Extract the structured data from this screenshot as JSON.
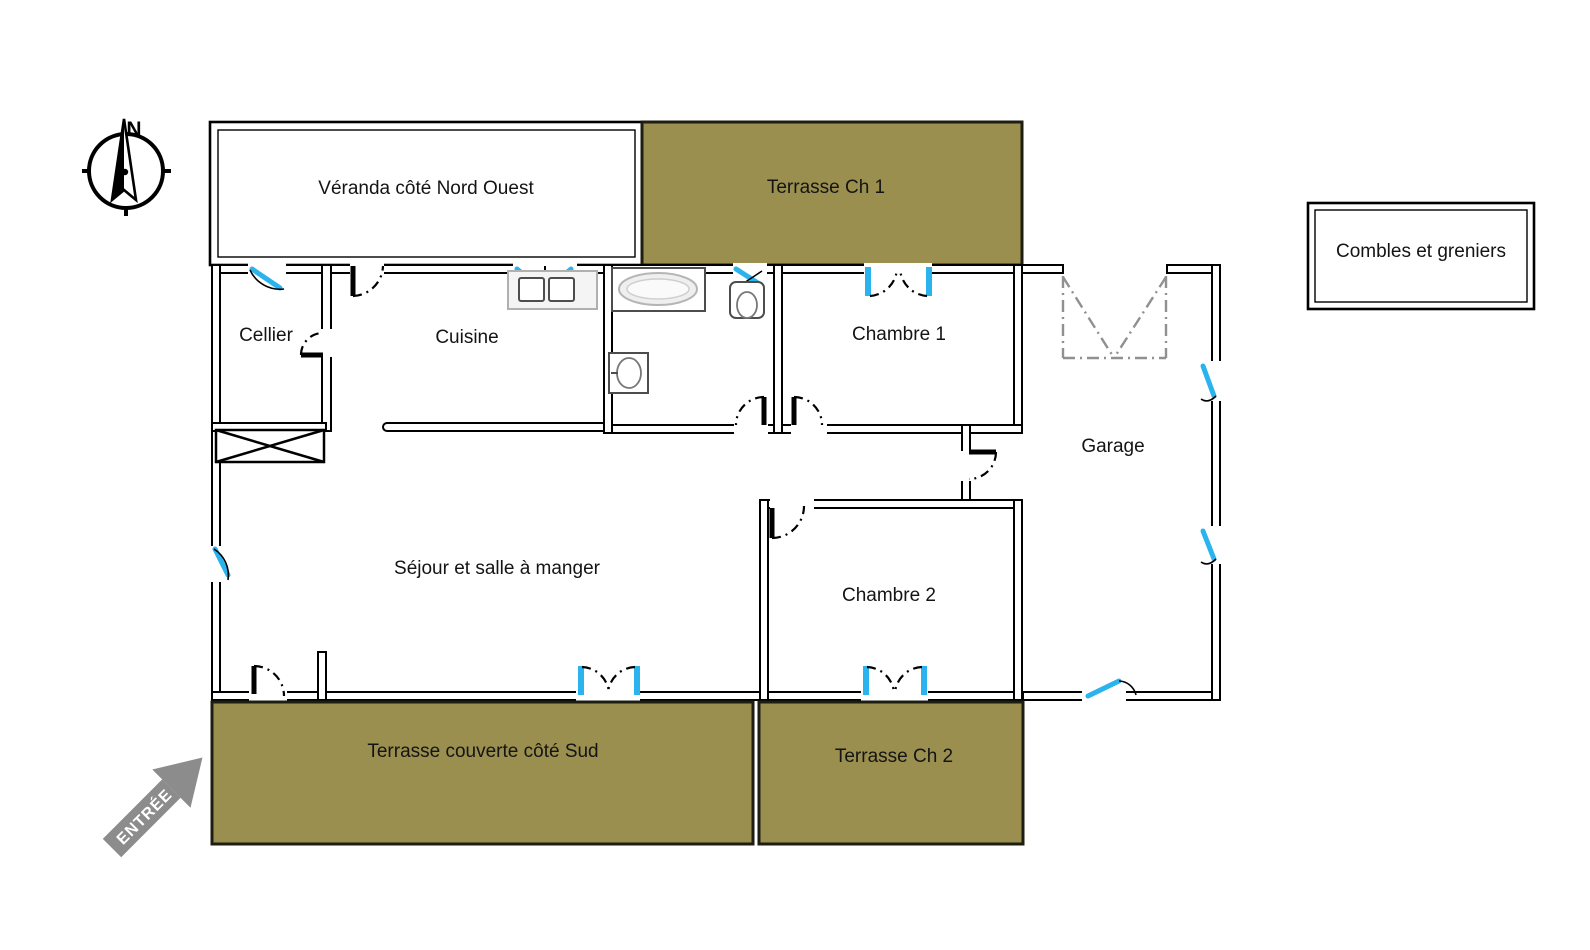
{
  "floor_plan": {
    "compass_north": "N",
    "entrance_label": "ENTRÉE",
    "rooms": {
      "veranda": "Véranda côté Nord Ouest",
      "terrasse_ch1": "Terrasse Ch 1",
      "combles": "Combles et greniers",
      "cellier": "Cellier",
      "cuisine": "Cuisine",
      "chambre1": "Chambre 1",
      "garage": "Garage",
      "sejour": "Séjour et salle à manger",
      "chambre2": "Chambre 2",
      "terrasse_sud": "Terrasse couverte côté Sud",
      "terrasse_ch2": "Terrasse Ch 2"
    }
  },
  "colors": {
    "terrace_fill": "#9a8f4f",
    "terrace_border": "#1d1d12",
    "window_blue": "#2bb3ee",
    "arrow_gray": "#8c8c8c",
    "garage_door_gray": "#909090"
  }
}
